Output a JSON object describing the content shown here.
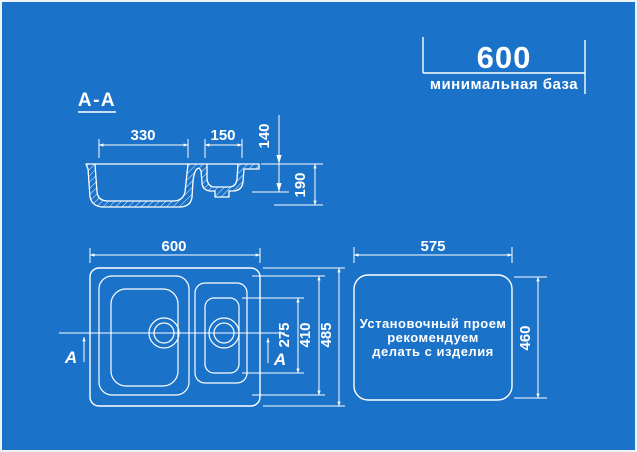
{
  "banner": {
    "value": "600",
    "caption": "минимальная база"
  },
  "section_view": {
    "label": "А-А",
    "dims": {
      "large_bowl_width": "330",
      "small_bowl_width": "150",
      "small_bowl_depth": "140",
      "large_bowl_depth": "190"
    }
  },
  "top_view": {
    "dims": {
      "width": "600",
      "height": "485",
      "bowl_zone_height": "410",
      "small_bowl_length": "275"
    },
    "section_marker": "А"
  },
  "cutout_view": {
    "dims": {
      "width": "575",
      "height": "460"
    },
    "note_lines": [
      "Установочный проем",
      "рекомендуем",
      "делать с изделия"
    ]
  },
  "colors": {
    "background": "#1b72c9",
    "line": "#ffffff"
  }
}
